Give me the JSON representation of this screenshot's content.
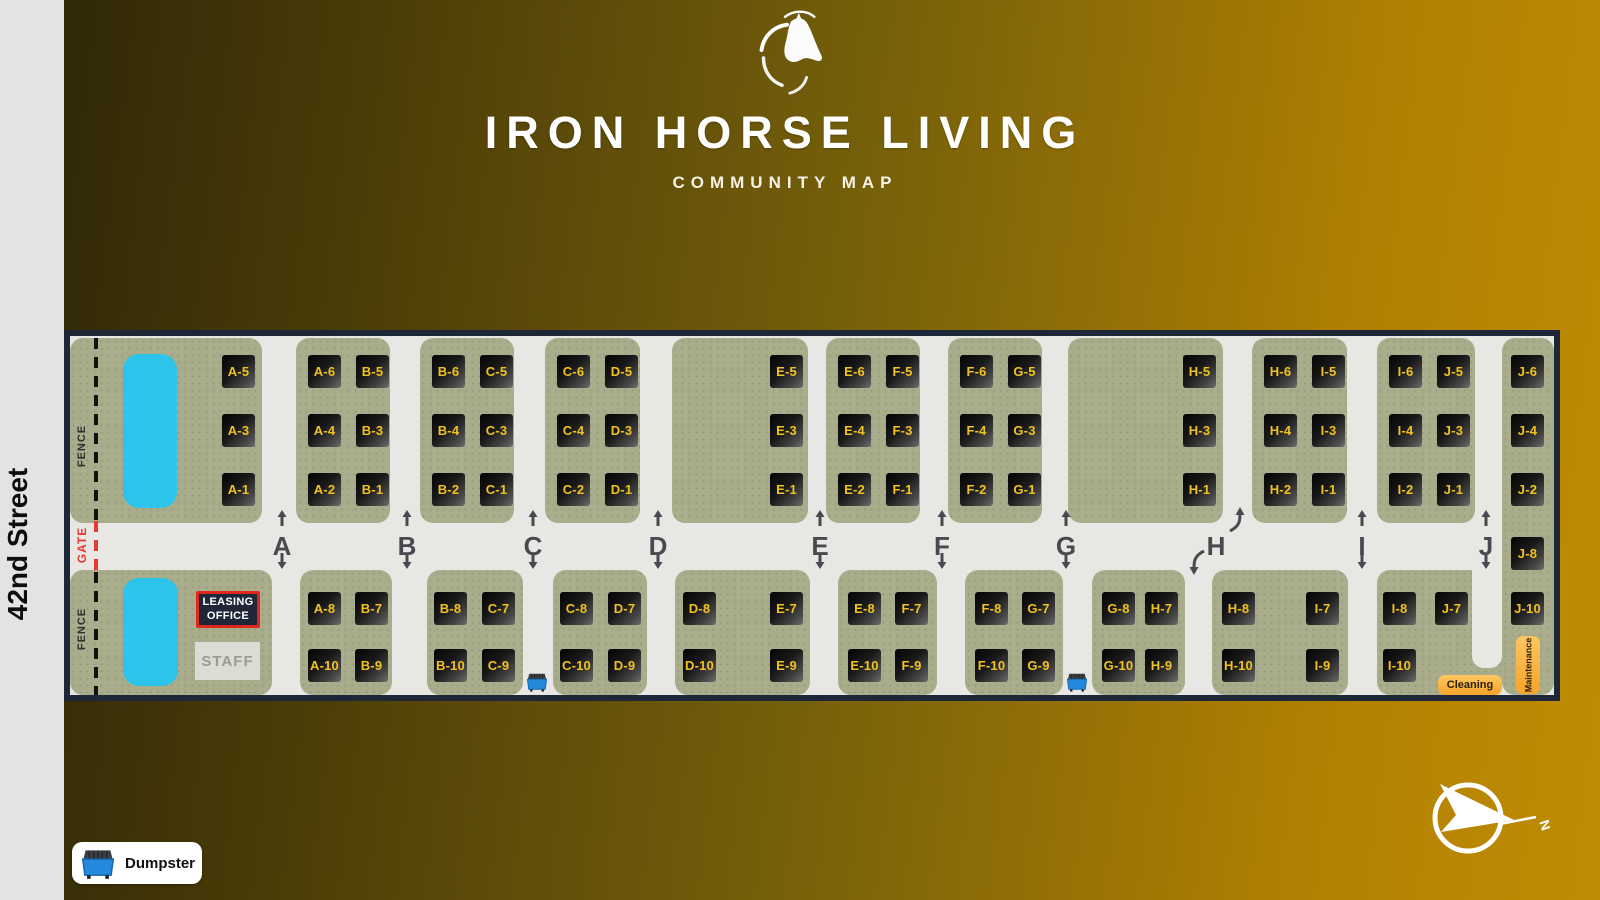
{
  "background": {
    "gradient_left": "#2b2407",
    "gradient_right": "#c08c03",
    "street_band": "#e3e3e3"
  },
  "header": {
    "logo": "horse-head-logo",
    "title": "IRON HORSE LIVING",
    "subtitle": "COMMUNITY MAP"
  },
  "street": {
    "label": "42nd Street"
  },
  "legend": {
    "label": "Dumpster",
    "icon": "dumpster-icon"
  },
  "compass": {
    "label": "N",
    "icon": "compass-icon"
  },
  "map": {
    "colors": {
      "navy": "#1d2738",
      "road": "#e8e7e4",
      "green": "#a9ad8c",
      "yellow": "#f2c21c",
      "pool": "#2cc5e9",
      "red": "#e8392e",
      "orange": "#f7a32a",
      "arrow": "#474a4e"
    },
    "fence": {
      "labels": [
        {
          "text": "FENCE",
          "y": 117
        },
        {
          "text": "FENCE",
          "y": 300
        }
      ],
      "gate": {
        "text": "GATE",
        "y": 214
      }
    },
    "leasing_office": {
      "line1": "LEASING",
      "line2": "OFFICE"
    },
    "staff": {
      "label": "STAFF"
    },
    "cleaning": {
      "label": "Cleaning"
    },
    "maintenance": {
      "label": "Maintenance"
    },
    "sections": [
      {
        "letter": "A",
        "x": 218
      },
      {
        "letter": "B",
        "x": 343
      },
      {
        "letter": "C",
        "x": 469
      },
      {
        "letter": "D",
        "x": 594
      },
      {
        "letter": "E",
        "x": 756
      },
      {
        "letter": "F",
        "x": 878
      },
      {
        "letter": "G",
        "x": 1002
      },
      {
        "letter": "H",
        "x": 1152,
        "curved": true,
        "up_x": 1164,
        "down_x": 1124
      },
      {
        "letter": "I",
        "x": 1298
      },
      {
        "letter": "J",
        "x": 1422
      }
    ],
    "row_y": {
      "top": [
        25,
        84,
        143
      ],
      "bottom": [
        262,
        319
      ]
    },
    "blocks": [
      {
        "id": "top-1",
        "band": "top",
        "x": 6,
        "y": 8,
        "w": 192,
        "h": 185,
        "tiles": [
          {
            "label": "A-5",
            "x": 158,
            "row": 0
          },
          {
            "label": "A-3",
            "x": 158,
            "row": 1
          },
          {
            "label": "A-1",
            "x": 158,
            "row": 2
          }
        ]
      },
      {
        "id": "top-2",
        "band": "top",
        "x": 232,
        "y": 8,
        "w": 94,
        "h": 185,
        "tiles": [
          {
            "label": "A-6",
            "x": 244,
            "row": 0
          },
          {
            "label": "B-5",
            "x": 292,
            "row": 0
          },
          {
            "label": "A-4",
            "x": 244,
            "row": 1
          },
          {
            "label": "B-3",
            "x": 292,
            "row": 1
          },
          {
            "label": "A-2",
            "x": 244,
            "row": 2
          },
          {
            "label": "B-1",
            "x": 292,
            "row": 2
          }
        ]
      },
      {
        "id": "top-3",
        "band": "top",
        "x": 356,
        "y": 8,
        "w": 94,
        "h": 185,
        "tiles": [
          {
            "label": "B-6",
            "x": 368,
            "row": 0
          },
          {
            "label": "C-5",
            "x": 416,
            "row": 0
          },
          {
            "label": "B-4",
            "x": 368,
            "row": 1
          },
          {
            "label": "C-3",
            "x": 416,
            "row": 1
          },
          {
            "label": "B-2",
            "x": 368,
            "row": 2
          },
          {
            "label": "C-1",
            "x": 416,
            "row": 2
          }
        ]
      },
      {
        "id": "top-4",
        "band": "top",
        "x": 481,
        "y": 8,
        "w": 95,
        "h": 185,
        "tiles": [
          {
            "label": "C-6",
            "x": 493,
            "row": 0
          },
          {
            "label": "D-5",
            "x": 541,
            "row": 0
          },
          {
            "label": "C-4",
            "x": 493,
            "row": 1
          },
          {
            "label": "D-3",
            "x": 541,
            "row": 1
          },
          {
            "label": "C-2",
            "x": 493,
            "row": 2
          },
          {
            "label": "D-1",
            "x": 541,
            "row": 2
          }
        ]
      },
      {
        "id": "top-5",
        "band": "top",
        "x": 608,
        "y": 8,
        "w": 136,
        "h": 185,
        "tiles": [
          {
            "label": "E-5",
            "x": 706,
            "row": 0
          },
          {
            "label": "E-3",
            "x": 706,
            "row": 1
          },
          {
            "label": "E-1",
            "x": 706,
            "row": 2
          }
        ]
      },
      {
        "id": "top-6",
        "band": "top",
        "x": 762,
        "y": 8,
        "w": 94,
        "h": 185,
        "tiles": [
          {
            "label": "E-6",
            "x": 774,
            "row": 0
          },
          {
            "label": "F-5",
            "x": 822,
            "row": 0
          },
          {
            "label": "E-4",
            "x": 774,
            "row": 1
          },
          {
            "label": "F-3",
            "x": 822,
            "row": 1
          },
          {
            "label": "E-2",
            "x": 774,
            "row": 2
          },
          {
            "label": "F-1",
            "x": 822,
            "row": 2
          }
        ]
      },
      {
        "id": "top-7",
        "band": "top",
        "x": 884,
        "y": 8,
        "w": 94,
        "h": 185,
        "tiles": [
          {
            "label": "F-6",
            "x": 896,
            "row": 0
          },
          {
            "label": "G-5",
            "x": 944,
            "row": 0
          },
          {
            "label": "F-4",
            "x": 896,
            "row": 1
          },
          {
            "label": "G-3",
            "x": 944,
            "row": 1
          },
          {
            "label": "F-2",
            "x": 896,
            "row": 2
          },
          {
            "label": "G-1",
            "x": 944,
            "row": 2
          }
        ]
      },
      {
        "id": "top-8",
        "band": "top",
        "x": 1004,
        "y": 8,
        "w": 155,
        "h": 185,
        "tiles": [
          {
            "label": "H-5",
            "x": 1119,
            "row": 0
          },
          {
            "label": "H-3",
            "x": 1119,
            "row": 1
          },
          {
            "label": "H-1",
            "x": 1119,
            "row": 2
          }
        ]
      },
      {
        "id": "top-9",
        "band": "top",
        "x": 1188,
        "y": 8,
        "w": 95,
        "h": 185,
        "tiles": [
          {
            "label": "H-6",
            "x": 1200,
            "row": 0
          },
          {
            "label": "I-5",
            "x": 1248,
            "row": 0
          },
          {
            "label": "H-4",
            "x": 1200,
            "row": 1
          },
          {
            "label": "I-3",
            "x": 1248,
            "row": 1
          },
          {
            "label": "H-2",
            "x": 1200,
            "row": 2
          },
          {
            "label": "I-1",
            "x": 1248,
            "row": 2
          }
        ]
      },
      {
        "id": "top-10",
        "band": "top",
        "x": 1313,
        "y": 8,
        "w": 98,
        "h": 185,
        "tiles": [
          {
            "label": "I-6",
            "x": 1325,
            "row": 0
          },
          {
            "label": "J-5",
            "x": 1373,
            "row": 0
          },
          {
            "label": "I-4",
            "x": 1325,
            "row": 1
          },
          {
            "label": "J-3",
            "x": 1373,
            "row": 1
          },
          {
            "label": "I-2",
            "x": 1325,
            "row": 2
          },
          {
            "label": "J-1",
            "x": 1373,
            "row": 2
          }
        ]
      },
      {
        "id": "right-strip",
        "band": "top",
        "x": 1438,
        "y": 8,
        "w": 52,
        "h": 357,
        "tiles": [
          {
            "label": "J-6",
            "x": 1447,
            "y": 25
          },
          {
            "label": "J-4",
            "x": 1447,
            "y": 84
          },
          {
            "label": "J-2",
            "x": 1447,
            "y": 143
          },
          {
            "label": "J-8",
            "x": 1447,
            "y": 207
          },
          {
            "label": "J-10",
            "x": 1447,
            "y": 262
          }
        ]
      },
      {
        "id": "bottom-1",
        "band": "bottom",
        "x": 6,
        "y": 240,
        "w": 202,
        "h": 125,
        "tiles": []
      },
      {
        "id": "bottom-2",
        "band": "bottom",
        "x": 236,
        "y": 240,
        "w": 92,
        "h": 125,
        "tiles": [
          {
            "label": "A-8",
            "x": 244,
            "row": 0
          },
          {
            "label": "B-7",
            "x": 291,
            "row": 0
          },
          {
            "label": "A-10",
            "x": 244,
            "row": 1
          },
          {
            "label": "B-9",
            "x": 291,
            "row": 1
          }
        ]
      },
      {
        "id": "bottom-3",
        "band": "bottom",
        "x": 363,
        "y": 240,
        "w": 96,
        "h": 125,
        "tiles": [
          {
            "label": "B-8",
            "x": 370,
            "row": 0
          },
          {
            "label": "C-7",
            "x": 418,
            "row": 0
          },
          {
            "label": "B-10",
            "x": 370,
            "row": 1
          },
          {
            "label": "C-9",
            "x": 418,
            "row": 1
          }
        ]
      },
      {
        "id": "bottom-4",
        "band": "bottom",
        "x": 489,
        "y": 240,
        "w": 94,
        "h": 125,
        "tiles": [
          {
            "label": "C-8",
            "x": 496,
            "row": 0
          },
          {
            "label": "D-7",
            "x": 544,
            "row": 0
          },
          {
            "label": "C-10",
            "x": 496,
            "row": 1
          },
          {
            "label": "D-9",
            "x": 544,
            "row": 1
          }
        ]
      },
      {
        "id": "bottom-5",
        "band": "bottom",
        "x": 611,
        "y": 240,
        "w": 135,
        "h": 125,
        "tiles": [
          {
            "label": "D-8",
            "x": 619,
            "row": 0
          },
          {
            "label": "E-7",
            "x": 706,
            "row": 0
          },
          {
            "label": "D-10",
            "x": 619,
            "row": 1
          },
          {
            "label": "E-9",
            "x": 706,
            "row": 1
          }
        ]
      },
      {
        "id": "bottom-6",
        "band": "bottom",
        "x": 774,
        "y": 240,
        "w": 99,
        "h": 125,
        "tiles": [
          {
            "label": "E-8",
            "x": 784,
            "row": 0
          },
          {
            "label": "F-7",
            "x": 831,
            "row": 0
          },
          {
            "label": "E-10",
            "x": 784,
            "row": 1
          },
          {
            "label": "F-9",
            "x": 831,
            "row": 1
          }
        ]
      },
      {
        "id": "bottom-7",
        "band": "bottom",
        "x": 901,
        "y": 240,
        "w": 98,
        "h": 125,
        "tiles": [
          {
            "label": "F-8",
            "x": 911,
            "row": 0
          },
          {
            "label": "G-7",
            "x": 958,
            "row": 0
          },
          {
            "label": "F-10",
            "x": 911,
            "row": 1
          },
          {
            "label": "G-9",
            "x": 958,
            "row": 1
          }
        ]
      },
      {
        "id": "bottom-8",
        "band": "bottom",
        "x": 1028,
        "y": 240,
        "w": 93,
        "h": 125,
        "tiles": [
          {
            "label": "G-8",
            "x": 1038,
            "row": 0
          },
          {
            "label": "H-7",
            "x": 1081,
            "row": 0
          },
          {
            "label": "G-10",
            "x": 1038,
            "row": 1
          },
          {
            "label": "H-9",
            "x": 1081,
            "row": 1
          }
        ]
      },
      {
        "id": "bottom-9",
        "band": "bottom",
        "x": 1148,
        "y": 240,
        "w": 136,
        "h": 125,
        "tiles": [
          {
            "label": "H-8",
            "x": 1158,
            "row": 0
          },
          {
            "label": "I-7",
            "x": 1242,
            "row": 0
          },
          {
            "label": "H-10",
            "x": 1158,
            "row": 1
          },
          {
            "label": "I-9",
            "x": 1242,
            "row": 1
          }
        ]
      },
      {
        "id": "bottom-10",
        "band": "bottom",
        "x": 1313,
        "y": 240,
        "w": 125,
        "h": 125,
        "tiles": [
          {
            "label": "I-8",
            "x": 1319,
            "row": 0
          },
          {
            "label": "J-7",
            "x": 1371,
            "row": 0
          },
          {
            "label": "I-10",
            "x": 1319,
            "row": 1
          }
        ]
      }
    ],
    "pools": [
      {
        "x": 59,
        "y": 24,
        "w": 54,
        "h": 154
      },
      {
        "x": 59,
        "y": 248,
        "w": 55,
        "h": 108
      }
    ],
    "dumpsters": [
      {
        "x": 461,
        "y": 341
      },
      {
        "x": 1001,
        "y": 341
      }
    ],
    "road_notch": {
      "x": 1408,
      "y": 240,
      "w": 30,
      "h": 98
    }
  }
}
